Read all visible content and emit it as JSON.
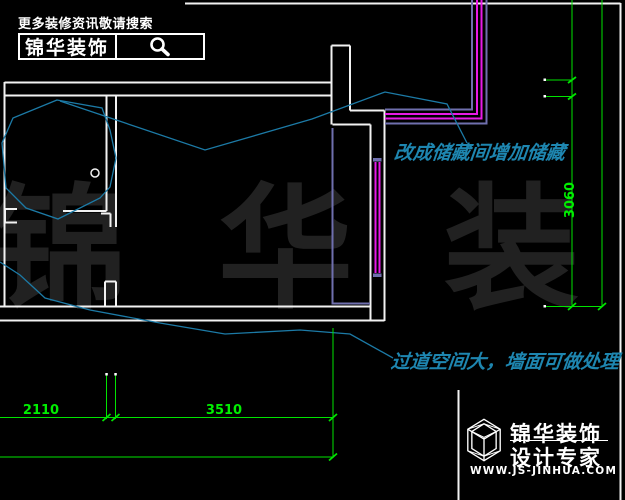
{
  "banner": {
    "tagline": "更多装修资讯敬请搜索",
    "brand": "锦华装饰",
    "search_icon": "magnifier"
  },
  "annotations": [
    {
      "text": "改成储藏间增加储藏",
      "color": "#1e86b0"
    },
    {
      "text": "过道空间大，墙面可做处理",
      "color": "#1e86b0"
    }
  ],
  "dimensions": {
    "bottom": [
      {
        "label": "2110"
      },
      {
        "label": "3510"
      }
    ],
    "right": [
      {
        "label": "3060"
      }
    ],
    "color": "#00e400"
  },
  "watermark": {
    "text": "锦 华 装 饰",
    "color": "#212121"
  },
  "logo": {
    "icon": "cube-wireframe",
    "line1": "锦华装饰",
    "line2": "设计专家",
    "website": "WWW.JS-JINHUA.COM"
  },
  "colors": {
    "background": "#000000",
    "walls": "#f2f2f2",
    "finish_slate": "#6f6fae",
    "finish_magenta": "#e81ae8",
    "sketch_cyan": "#1c7aa6",
    "dimension_green": "#00e400"
  }
}
